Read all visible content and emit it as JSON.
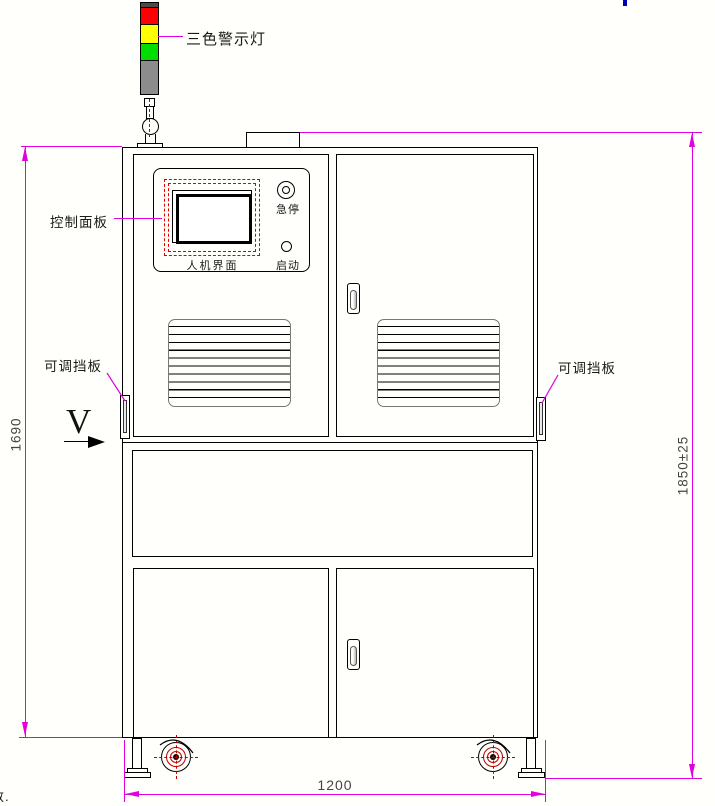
{
  "annotations": {
    "tower_light": "三色警示灯",
    "control_panel": "控制面板",
    "hmi": "人机界面",
    "estop": "急停",
    "start": "启动",
    "baffle_left": "可调挡板",
    "baffle_right": "可调挡板",
    "view_direction": "V",
    "corner_fragment": "数."
  },
  "dimensions": {
    "body_height": "1690",
    "total_height": "1850±25",
    "base_width": "1200"
  },
  "colors": {
    "beacon_red": "#ff0000",
    "beacon_yellow": "#ffff00",
    "beacon_green": "#00dd00",
    "beacon_gray": "#8c8c8c",
    "dimension_magenta": "#e000e0",
    "screen_dash_red": "#e00000",
    "caster_red": "#bb0000",
    "blue_tick": "#0000bb"
  }
}
